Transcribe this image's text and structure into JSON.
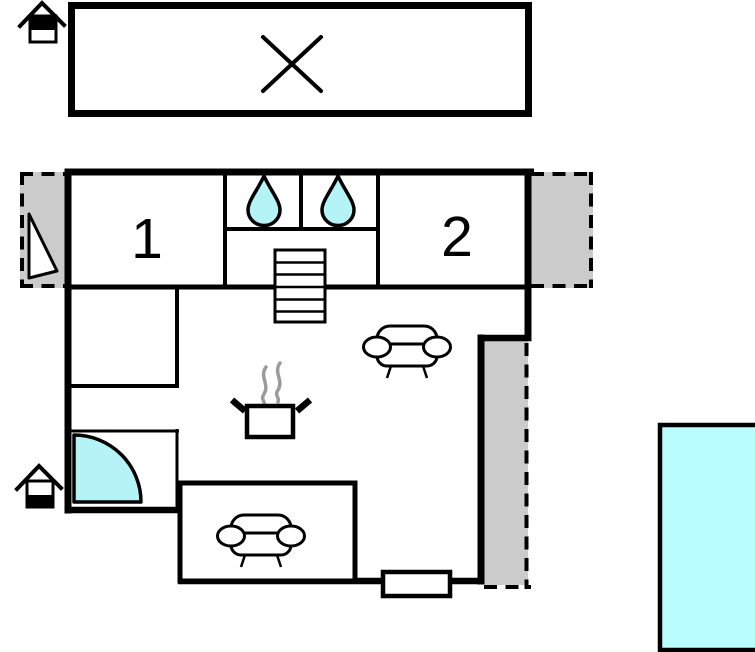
{
  "rooms": [
    {
      "label": "1"
    },
    {
      "label": "2"
    }
  ],
  "colors": {
    "wall": "#000000",
    "water_fixture": "#b5f4f6",
    "pool": "#bafdff",
    "terrace_gray": "#cbcbcb",
    "steam_gray": "#9b9b9b",
    "background": "#ffffff"
  },
  "symbols": {
    "house_storey_icons": [
      {
        "name": "house-storey-icon-upper",
        "filled_storey": "upper"
      },
      {
        "name": "house-storey-icon-lower",
        "filled_storey": "lower"
      }
    ],
    "crossed_out_area": 1,
    "water_drop_icons": 2,
    "sofa_icons": 2,
    "stairs_icons": 1,
    "door_swing_icons": 2,
    "cooking_pot_icon": 1,
    "window_icon": 1,
    "pool_icon": 1,
    "terrace_areas": 3
  }
}
